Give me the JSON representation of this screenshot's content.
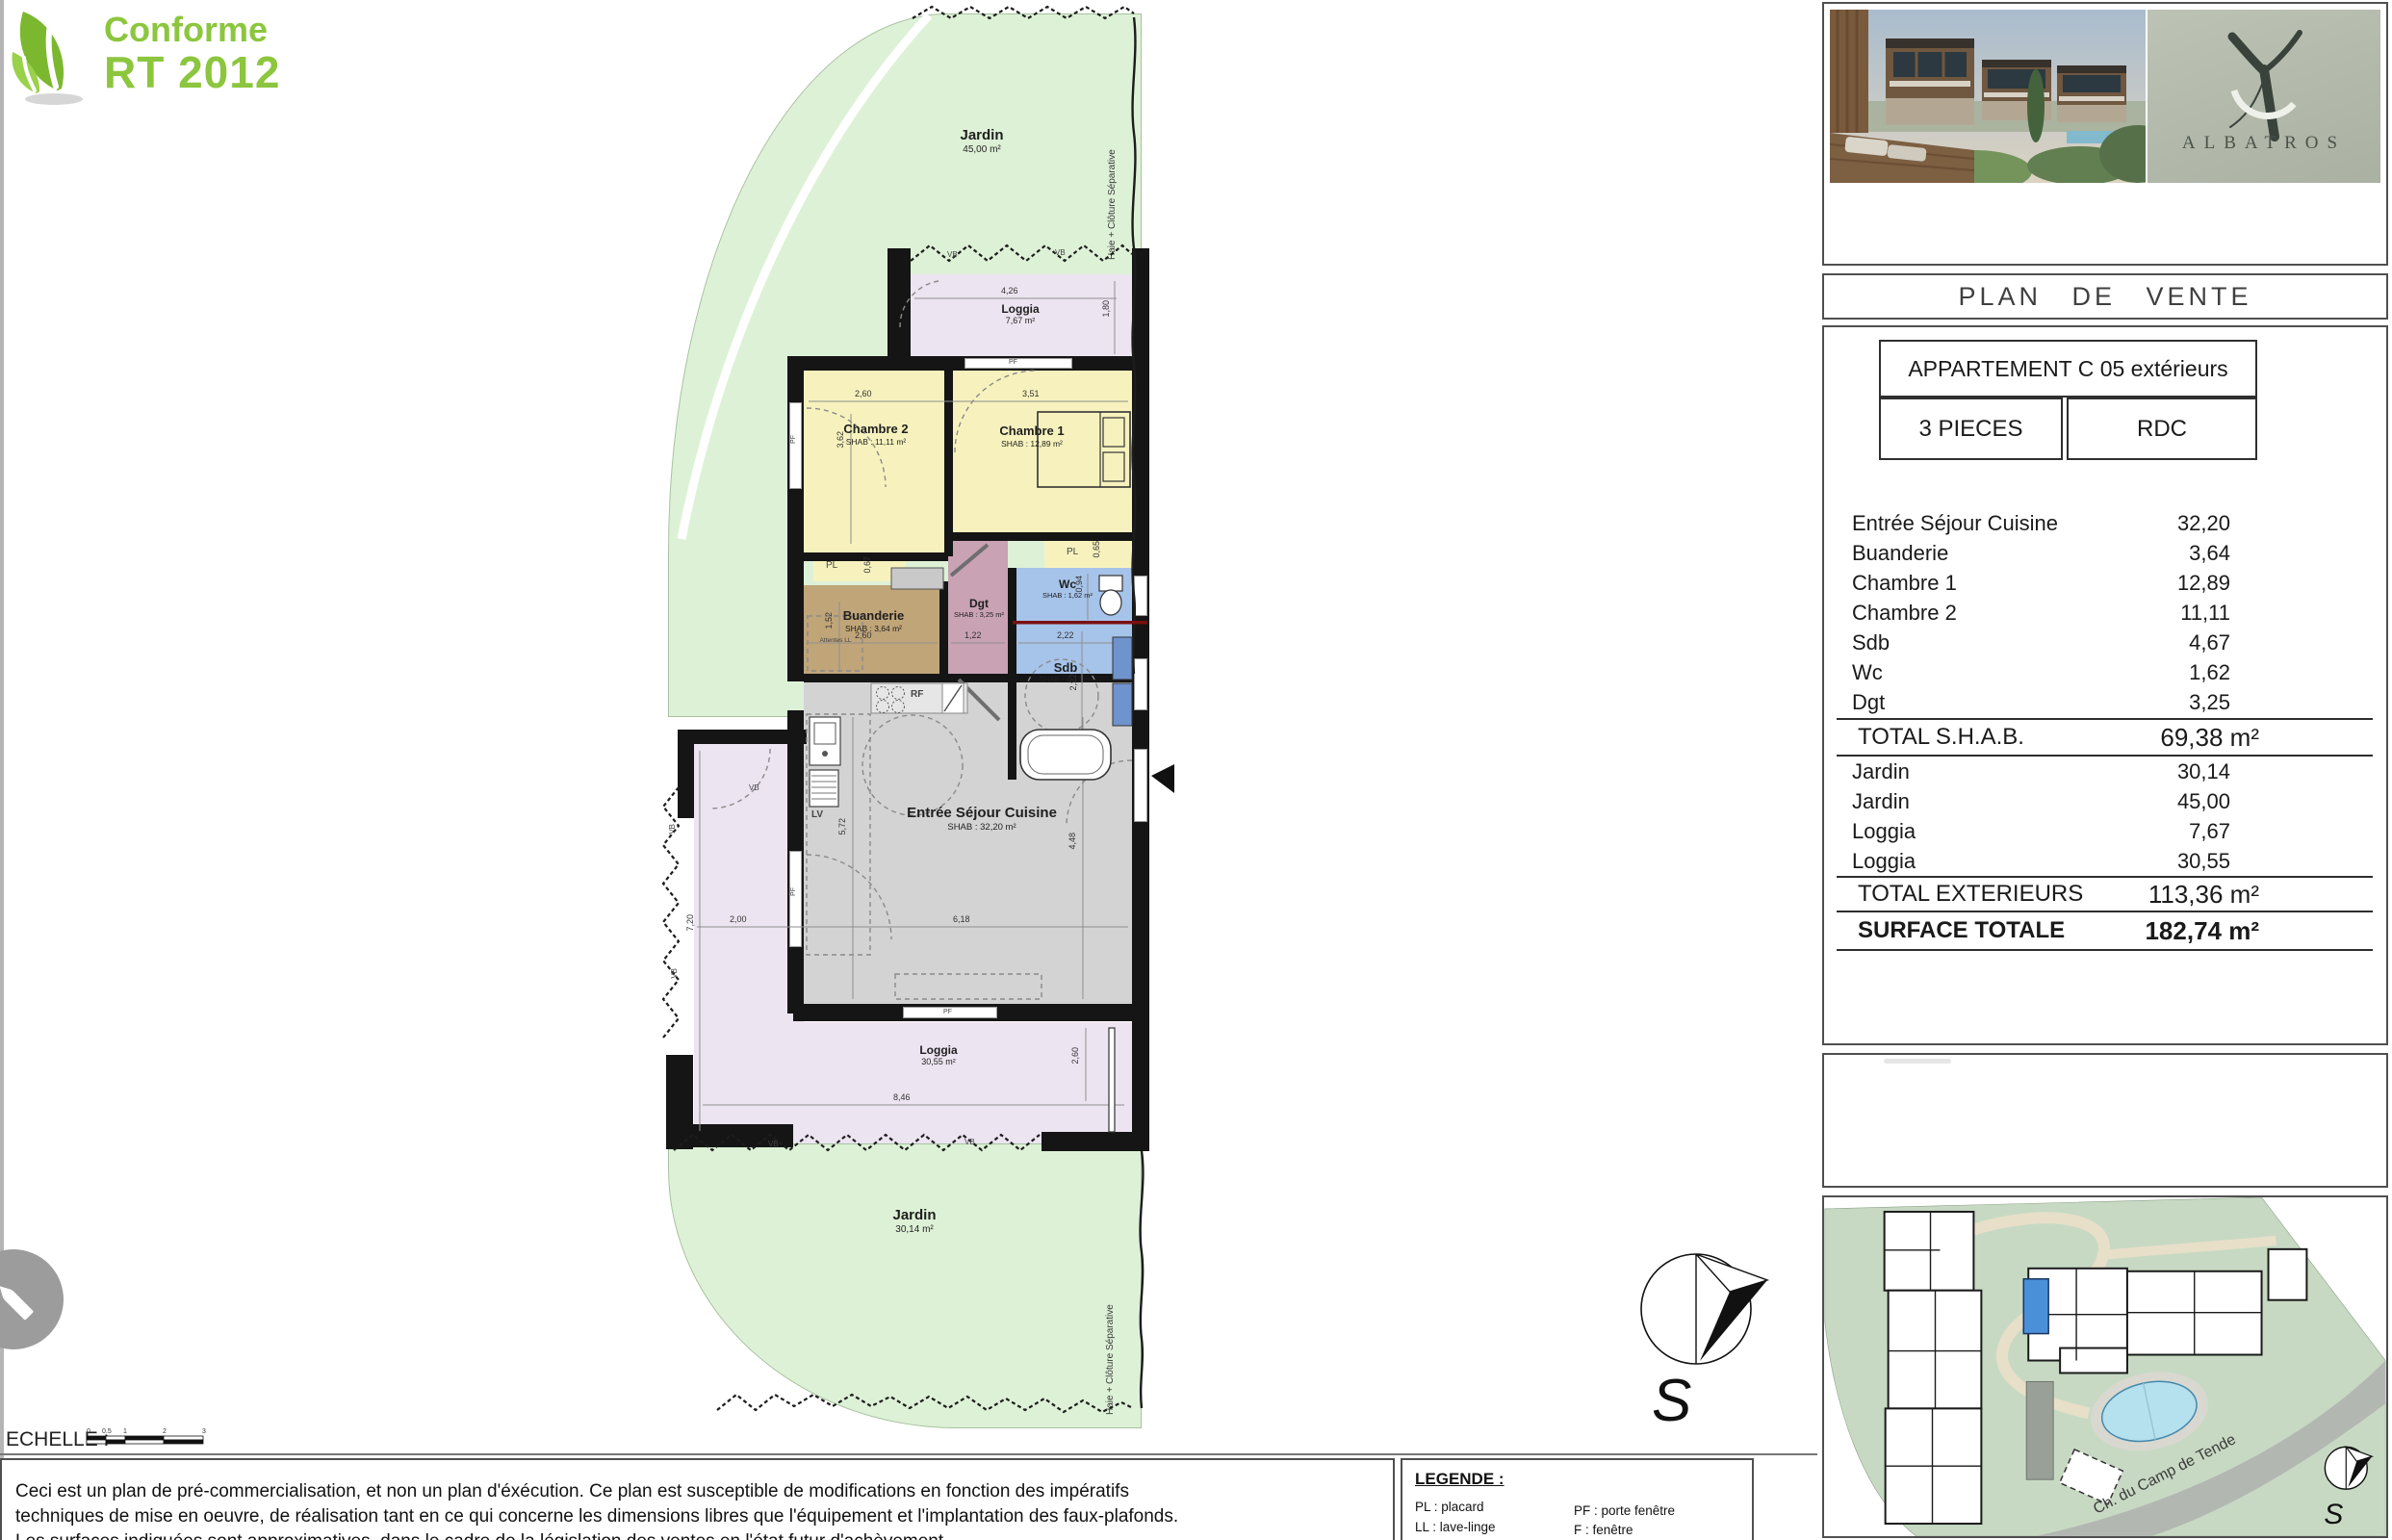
{
  "badge": {
    "line1": "Conforme",
    "line2": "RT 2012"
  },
  "panel": {
    "albatros": "ALBATROS",
    "plan_de_vente": "PLAN DE VENTE",
    "apartment_title": "APPARTEMENT C 05 extérieurs",
    "pieces": "3 PIECES",
    "floor": "RDC",
    "areas": [
      {
        "label": "Entrée Séjour Cuisine",
        "value": "32,20"
      },
      {
        "label": "Buanderie",
        "value": "3,64"
      },
      {
        "label": "Chambre 1",
        "value": "12,89"
      },
      {
        "label": "Chambre 2",
        "value": "11,11"
      },
      {
        "label": "Sdb",
        "value": "4,67"
      },
      {
        "label": "Wc",
        "value": "1,62"
      },
      {
        "label": "Dgt",
        "value": "3,25"
      }
    ],
    "total_shab": {
      "label": "TOTAL S.H.A.B.",
      "value": "69,38 m²"
    },
    "ext_areas": [
      {
        "label": "Jardin",
        "value": "30,14"
      },
      {
        "label": "Jardin",
        "value": "45,00"
      },
      {
        "label": "Loggia",
        "value": "7,67"
      },
      {
        "label": "Loggia",
        "value": "30,55"
      }
    ],
    "total_ext": {
      "label": "TOTAL EXTERIEURS",
      "value": "113,36 m²"
    },
    "total_surface": {
      "label": "SURFACE TOTALE",
      "value": "182,74 m²"
    }
  },
  "plan": {
    "rooms": {
      "jardin_top": {
        "name": "Jardin",
        "area": "45,00 m²"
      },
      "jardin_bottom": {
        "name": "Jardin",
        "area": "30,14 m²"
      },
      "loggia_top": {
        "name": "Loggia",
        "area": "7,67 m²"
      },
      "loggia_bottom": {
        "name": "Loggia",
        "area": "30,55 m²"
      },
      "chambre2": {
        "name": "Chambre 2",
        "shab": "SHAB : 11,11 m²"
      },
      "chambre1": {
        "name": "Chambre 1",
        "shab": "SHAB : 12,89 m²"
      },
      "buanderie": {
        "name": "Buanderie",
        "shab": "SHAB : 3,64 m²"
      },
      "dgt": {
        "name": "Dgt",
        "shab": "SHAB : 3,25 m²"
      },
      "wc": {
        "name": "Wc",
        "shab": "SHAB : 1,62 m²"
      },
      "sdb": {
        "name": "Sdb",
        "shab": "SHAB : 4,67 m²"
      },
      "sejour": {
        "name": "Entrée Séjour Cuisine",
        "shab": "SHAB : 32,20 m²"
      }
    },
    "dims": {
      "loggia_top_w": "4,26",
      "loggia_top_h": "1,80",
      "ch2_w": "2,60",
      "ch2_h": "3,62",
      "ch1_w": "3,51",
      "buand_w": "2,60",
      "buand_h": "1,52",
      "pl_ch2": "0,67",
      "pl_ch1": "0,65",
      "dgt_w": "1,22",
      "wc_h": "0,94",
      "sdb_w": "2,22",
      "sdb_h": "2,22",
      "liv_w": "6,18",
      "liv_h_left": "5,72",
      "liv_h_right": "4,48",
      "loggia_w": "8,46",
      "loggia_arm_w": "2,00",
      "loggia_arm_h": "7,20",
      "loggia_bot_h": "2,60"
    },
    "tags": {
      "pl": "PL",
      "pf": "PF",
      "vb": "VB",
      "rf": "RF",
      "lv": "LV",
      "attentes_ll": "Attentes LL",
      "hedge": "Haie + Clôture Séparative"
    },
    "compass_s": "S"
  },
  "site_plan": {
    "road": "Ch. du Camp de Tende",
    "compass_s": "S"
  },
  "scale": {
    "label": "ECHELLE :",
    "ticks": [
      "0",
      "0.5",
      "1",
      "2",
      "3"
    ]
  },
  "legend": {
    "title": "LEGENDE :",
    "left": [
      "PL : placard",
      "LL : lave-linge",
      "LV : lave-vaisselle"
    ],
    "right": [
      "PF : porte fenêtre",
      "F : fenêtre",
      "FSA : fenêtre sur allège"
    ]
  },
  "disclaimer": [
    "Ceci est un plan de pré-commercialisation, et non un plan d'éxécution. Ce plan est susceptible de modifications en fonction des impératifs",
    "techniques de mise en oeuvre, de réalisation tant en ce qui concerne les dimensions libres que l'équipement et l'implantation des faux-plafonds.",
    "Les surfaces indiquées sont approximatives, dans le cadre de la législation des ventes en l'état futur d'achèvement."
  ],
  "colors": {
    "jardin": "#ddf1d6",
    "loggia": "#ece4f0",
    "chambre": "#f7f2bd",
    "buanderie": "#c0a579",
    "dgt": "#c9a2b4",
    "sanitaire": "#a6c3e9",
    "sejour": "#d3d3d3",
    "wall": "#151515",
    "rt2012_green": "#8cc63e",
    "albatros_bg": "#b7beb0",
    "site_green": "#c7d9c3",
    "unit_highlight": "#4a90d9"
  }
}
